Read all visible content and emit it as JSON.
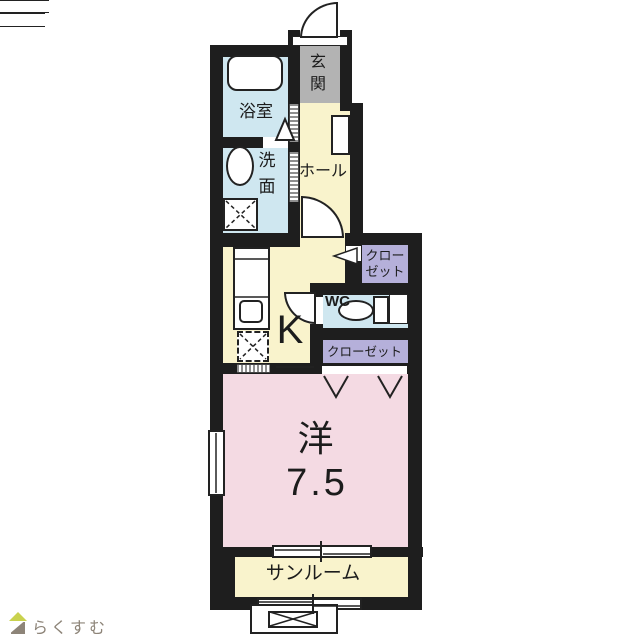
{
  "plan_title": "1K apartment floor plan",
  "rooms": {
    "genkan": {
      "label": "玄関",
      "color": "#b3b3b3"
    },
    "bathroom": {
      "label": "浴室",
      "color": "#cfe7f0"
    },
    "washroom": {
      "label": "洗面",
      "color": "#cfe7f0"
    },
    "hall": {
      "label": "ホール",
      "color": "#f9f3cc"
    },
    "kitchen": {
      "label": "K",
      "color": "#f9f3cc"
    },
    "closet_upper": {
      "label": "クローゼット",
      "color": "#b5b0da"
    },
    "wc": {
      "label": "WC",
      "color": "#cfe7f0"
    },
    "closet_lower": {
      "label": "クローゼット",
      "color": "#b5b0da"
    },
    "western_room": {
      "label": "洋",
      "size": "7.5",
      "color": "#f4dae3"
    },
    "sunroom": {
      "label": "サンルーム",
      "color": "#f9f3cc"
    }
  },
  "walls": {
    "color": "#1e1e1e"
  },
  "logo": {
    "text": "らくすむ",
    "text_color": "#8d8478",
    "roof_color": "#c9d24e",
    "body_color": "#8d8478"
  }
}
